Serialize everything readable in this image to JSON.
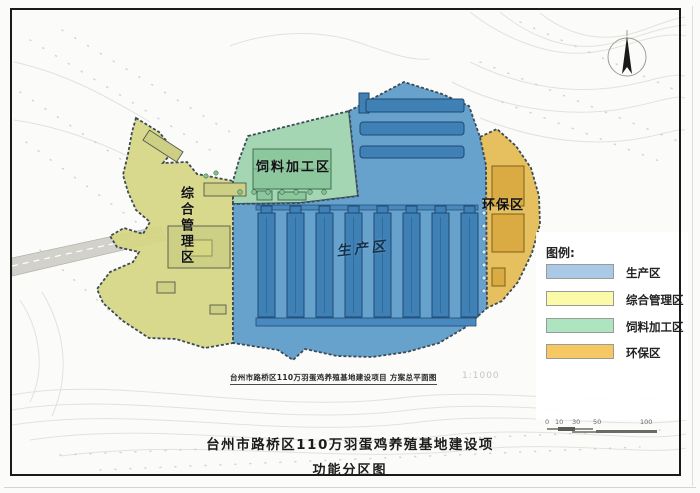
{
  "page": {
    "background": "#fbfbf9"
  },
  "map": {
    "zones": {
      "production": {
        "label": "生产区",
        "color": "#5a9ac9"
      },
      "management": {
        "label": "综合管理区",
        "color": "#d6d683"
      },
      "feed_processing": {
        "label": "饲料加工区",
        "color": "#9dd2ad"
      },
      "environmental": {
        "label": "环保区",
        "color": "#e5bd55"
      }
    },
    "caption": "台州市路桥区110万羽蛋鸡养殖基地建设项目 方案总平面图",
    "caption_scale": "1:1000"
  },
  "icons": {
    "north_arrow": "north-arrow-icon"
  },
  "legend": {
    "title": "图例:",
    "items": [
      {
        "label": "生产区",
        "color": "#aac9e6"
      },
      {
        "label": "综合管理区",
        "color": "#fbfaa8"
      },
      {
        "label": "饲料加工区",
        "color": "#aee4c0"
      },
      {
        "label": "环保区",
        "color": "#f6c864"
      }
    ]
  },
  "scale_bar": {
    "ticks": [
      "0",
      "10",
      "30",
      "50",
      "100"
    ]
  },
  "title": {
    "line1": "台州市路桥区110万羽蛋鸡养殖基地建设项",
    "line2": "功能分区图"
  }
}
